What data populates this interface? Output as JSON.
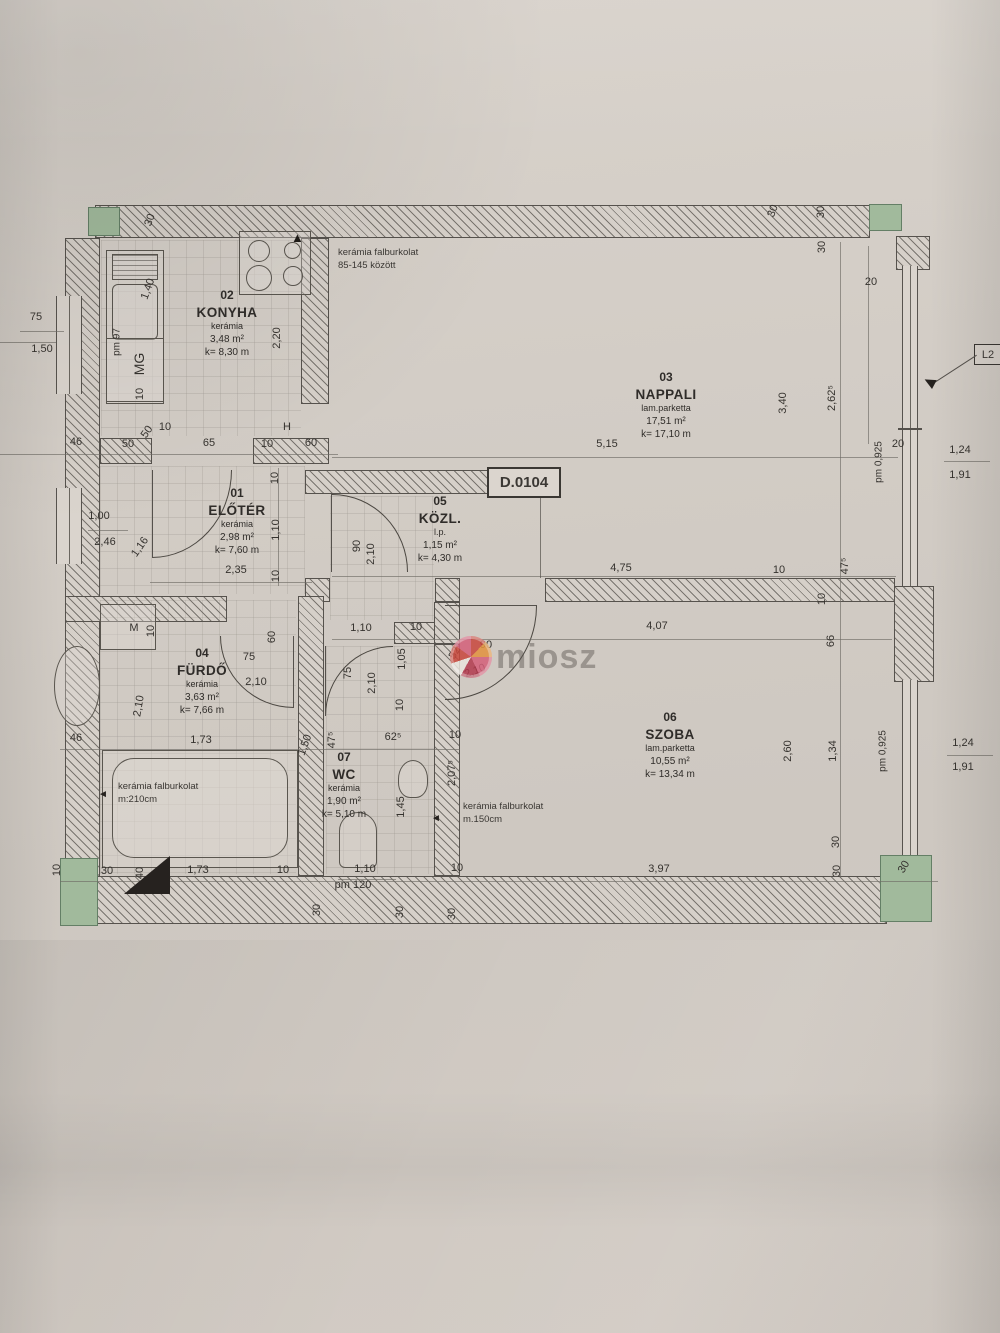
{
  "plan": {
    "id": "D.0104",
    "watermark": "miosz"
  },
  "callout": {
    "label": "L2"
  },
  "rooms": [
    {
      "num": "02",
      "name": "KONYHA",
      "finish": "kerámia",
      "area": "3,48 m²",
      "k": "k= 8,30 m",
      "x": 227,
      "y": 288
    },
    {
      "num": "03",
      "name": "NAPPALI",
      "finish": "lam.parketta",
      "area": "17,51 m²",
      "k": "k= 17,10 m",
      "x": 666,
      "y": 370
    },
    {
      "num": "01",
      "name": "ELŐTÉR",
      "finish": "kerámia",
      "area": "2,98 m²",
      "k": "k= 7,60 m",
      "x": 237,
      "y": 486
    },
    {
      "num": "05",
      "name": "KÖZL.",
      "finish": "l.p.",
      "area": "1,15 m²",
      "k": "k= 4,30 m",
      "x": 440,
      "y": 494
    },
    {
      "num": "04",
      "name": "FÜRDŐ",
      "finish": "kerámia",
      "area": "3,63 m²",
      "k": "k= 7,66 m",
      "x": 202,
      "y": 646
    },
    {
      "num": "06",
      "name": "SZOBA",
      "finish": "lam.parketta",
      "area": "10,55 m²",
      "k": "k= 13,34 m",
      "x": 670,
      "y": 710
    },
    {
      "num": "07",
      "name": "WC",
      "finish": "kerámia",
      "area": "1,90 m²",
      "k": "k= 5,10 m",
      "x": 344,
      "y": 750
    }
  ],
  "notes": [
    {
      "l1": "kerámia falburkolat",
      "l2": "85-145 között",
      "x": 338,
      "y": 246
    },
    {
      "l1": "kerámia falburkolat",
      "l2": "m:210cm",
      "x": 118,
      "y": 780
    },
    {
      "l1": "kerámia falburkolat",
      "l2": "m.150cm",
      "x": 463,
      "y": 800
    }
  ],
  "dims": [
    {
      "t": "30",
      "x": 150,
      "y": 220,
      "r": -70
    },
    {
      "t": "75",
      "x": 36,
      "y": 317
    },
    {
      "t": "1,50",
      "x": 42,
      "y": 349
    },
    {
      "t": "pm 97",
      "x": 117,
      "y": 342,
      "r": -90,
      "fs": 10
    },
    {
      "t": "MG",
      "x": 139,
      "y": 364,
      "r": -90,
      "fs": 14
    },
    {
      "t": "10",
      "x": 140,
      "y": 394,
      "r": -90
    },
    {
      "t": "1,40",
      "x": 148,
      "y": 289,
      "r": -70
    },
    {
      "t": "2,20",
      "x": 277,
      "y": 338,
      "r": -90
    },
    {
      "t": "46",
      "x": 76,
      "y": 442
    },
    {
      "t": "50",
      "x": 128,
      "y": 444
    },
    {
      "t": "50",
      "x": 147,
      "y": 432,
      "r": -55
    },
    {
      "t": "10",
      "x": 165,
      "y": 427
    },
    {
      "t": "65",
      "x": 209,
      "y": 443
    },
    {
      "t": "10",
      "x": 267,
      "y": 444
    },
    {
      "t": "60",
      "x": 311,
      "y": 443
    },
    {
      "t": "H",
      "x": 287,
      "y": 427
    },
    {
      "t": "5,15",
      "x": 607,
      "y": 444
    },
    {
      "t": "30",
      "x": 773,
      "y": 211,
      "r": -70
    },
    {
      "t": "30",
      "x": 821,
      "y": 212,
      "r": -90
    },
    {
      "t": "30",
      "x": 822,
      "y": 247,
      "r": -90
    },
    {
      "t": "20",
      "x": 871,
      "y": 282
    },
    {
      "t": "3,40",
      "x": 783,
      "y": 403,
      "r": -90
    },
    {
      "t": "2,62⁵",
      "x": 832,
      "y": 398,
      "r": -90
    },
    {
      "t": "20",
      "x": 898,
      "y": 444
    },
    {
      "t": "pm 0,925",
      "x": 879,
      "y": 462,
      "r": -90,
      "fs": 10
    },
    {
      "t": "1,24",
      "x": 960,
      "y": 450
    },
    {
      "t": "1,91",
      "x": 960,
      "y": 475
    },
    {
      "t": "1,00",
      "x": 99,
      "y": 516
    },
    {
      "t": "2,46",
      "x": 105,
      "y": 542
    },
    {
      "t": "1,16",
      "x": 140,
      "y": 547,
      "r": -55
    },
    {
      "t": "2,35",
      "x": 236,
      "y": 570
    },
    {
      "t": "10",
      "x": 275,
      "y": 478,
      "r": -90
    },
    {
      "t": "1,10",
      "x": 276,
      "y": 530,
      "r": -90
    },
    {
      "t": "10",
      "x": 276,
      "y": 576,
      "r": -90
    },
    {
      "t": "90",
      "x": 357,
      "y": 546,
      "r": -90
    },
    {
      "t": "2,10",
      "x": 371,
      "y": 554,
      "r": -90
    },
    {
      "t": "4,75",
      "x": 621,
      "y": 568
    },
    {
      "t": "10",
      "x": 779,
      "y": 570
    },
    {
      "t": "47⁵",
      "x": 845,
      "y": 566,
      "r": -90
    },
    {
      "t": "10",
      "x": 822,
      "y": 599,
      "r": -90
    },
    {
      "t": "1,10",
      "x": 361,
      "y": 628
    },
    {
      "t": "10",
      "x": 416,
      "y": 627
    },
    {
      "t": "4,07",
      "x": 657,
      "y": 626
    },
    {
      "t": "90",
      "x": 486,
      "y": 645
    },
    {
      "t": "52⁵",
      "x": 456,
      "y": 651,
      "r": -60
    },
    {
      "t": "2,10",
      "x": 475,
      "y": 671,
      "r": -20
    },
    {
      "t": "1,05",
      "x": 402,
      "y": 659,
      "r": -90
    },
    {
      "t": "M",
      "x": 134,
      "y": 628
    },
    {
      "t": "10",
      "x": 151,
      "y": 631,
      "r": -90
    },
    {
      "t": "60",
      "x": 272,
      "y": 637,
      "r": -90
    },
    {
      "t": "75",
      "x": 249,
      "y": 657
    },
    {
      "t": "2,10",
      "x": 256,
      "y": 682
    },
    {
      "t": "75",
      "x": 348,
      "y": 673,
      "r": -90
    },
    {
      "t": "2,10",
      "x": 372,
      "y": 683,
      "r": -90
    },
    {
      "t": "10",
      "x": 400,
      "y": 705,
      "r": -90
    },
    {
      "t": "2,10",
      "x": 139,
      "y": 706,
      "r": -80
    },
    {
      "t": "46",
      "x": 76,
      "y": 738
    },
    {
      "t": "1,73",
      "x": 201,
      "y": 740
    },
    {
      "t": "1,50",
      "x": 305,
      "y": 745,
      "r": -70
    },
    {
      "t": "47⁵",
      "x": 332,
      "y": 740,
      "r": -90
    },
    {
      "t": "62⁵",
      "x": 393,
      "y": 737
    },
    {
      "t": "10",
      "x": 455,
      "y": 735
    },
    {
      "t": "2,07⁵",
      "x": 452,
      "y": 773,
      "r": -90
    },
    {
      "t": "1,45",
      "x": 401,
      "y": 807,
      "r": -90
    },
    {
      "t": "66",
      "x": 831,
      "y": 641,
      "r": -90
    },
    {
      "t": "2,60",
      "x": 788,
      "y": 751,
      "r": -90
    },
    {
      "t": "1,34",
      "x": 833,
      "y": 751,
      "r": -90
    },
    {
      "t": "pm 0,925",
      "x": 883,
      "y": 751,
      "r": -90,
      "fs": 10
    },
    {
      "t": "1,24",
      "x": 963,
      "y": 743
    },
    {
      "t": "1,91",
      "x": 963,
      "y": 767
    },
    {
      "t": "10",
      "x": 57,
      "y": 870,
      "r": -90
    },
    {
      "t": "30",
      "x": 107,
      "y": 871
    },
    {
      "t": "40",
      "x": 140,
      "y": 873,
      "r": -90
    },
    {
      "t": "1,73",
      "x": 198,
      "y": 870
    },
    {
      "t": "10",
      "x": 283,
      "y": 870
    },
    {
      "t": "1,10",
      "x": 365,
      "y": 869
    },
    {
      "t": "pm 120",
      "x": 353,
      "y": 885
    },
    {
      "t": "10",
      "x": 457,
      "y": 868
    },
    {
      "t": "3,97",
      "x": 659,
      "y": 869
    },
    {
      "t": "30",
      "x": 317,
      "y": 910,
      "r": -90
    },
    {
      "t": "30",
      "x": 400,
      "y": 912,
      "r": -90
    },
    {
      "t": "30",
      "x": 452,
      "y": 914,
      "r": -90
    },
    {
      "t": "30",
      "x": 836,
      "y": 842,
      "r": -90
    },
    {
      "t": "30",
      "x": 837,
      "y": 871,
      "r": -90
    },
    {
      "t": "30",
      "x": 904,
      "y": 867,
      "r": -60
    }
  ]
}
